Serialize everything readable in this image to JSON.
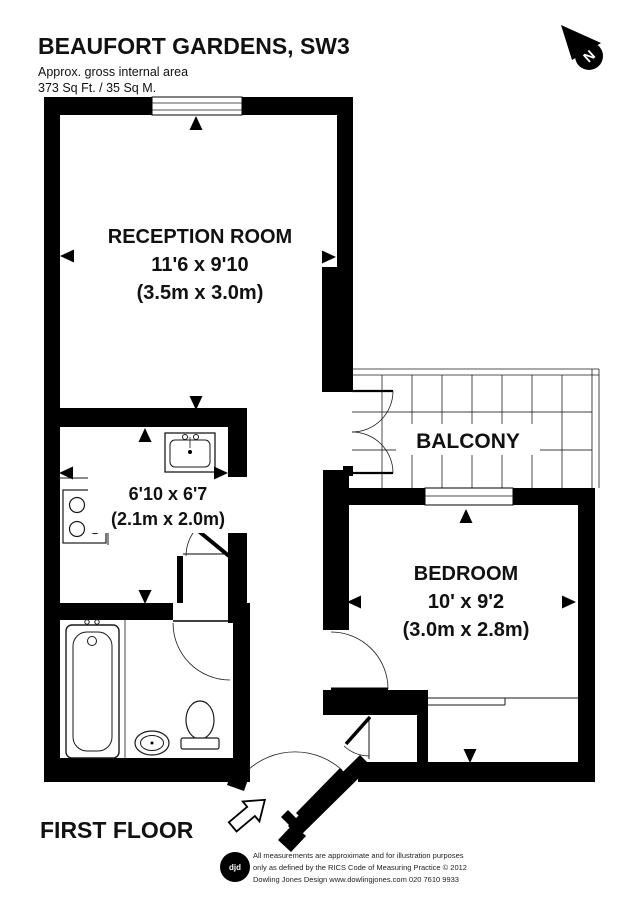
{
  "header": {
    "title": "BEAUFORT GARDENS, SW3",
    "area_line1": "Approx. gross internal area",
    "area_line2": "373 Sq Ft. / 35 Sq M."
  },
  "compass": {
    "north_label": "N"
  },
  "rooms": {
    "reception": {
      "name": "RECEPTION ROOM",
      "size_imperial": "11'6 x 9'10",
      "size_metric": "(3.5m x 3.0m)"
    },
    "kitchen": {
      "size_imperial": "6'10 x 6'7",
      "size_metric": "(2.1m x 2.0m)"
    },
    "balcony": {
      "name": "BALCONY"
    },
    "bedroom": {
      "name": "BEDROOM",
      "size_imperial": "10' x 9'2",
      "size_metric": "(3.0m x 2.8m)"
    }
  },
  "floor": {
    "label": "FIRST FLOOR"
  },
  "footer": {
    "logo_text": "djd",
    "disclaimer_line1": "All measurements are approximate and for illustration purposes",
    "disclaimer_line2": "only as defined by the RICS Code of Measuring Practice © 2012",
    "disclaimer_line3": "Dowling Jones Design www.dowlingjones.com 020 7610 9933"
  },
  "colors": {
    "wall": "#000000",
    "background": "#ffffff",
    "line": "#1a1a1a"
  }
}
